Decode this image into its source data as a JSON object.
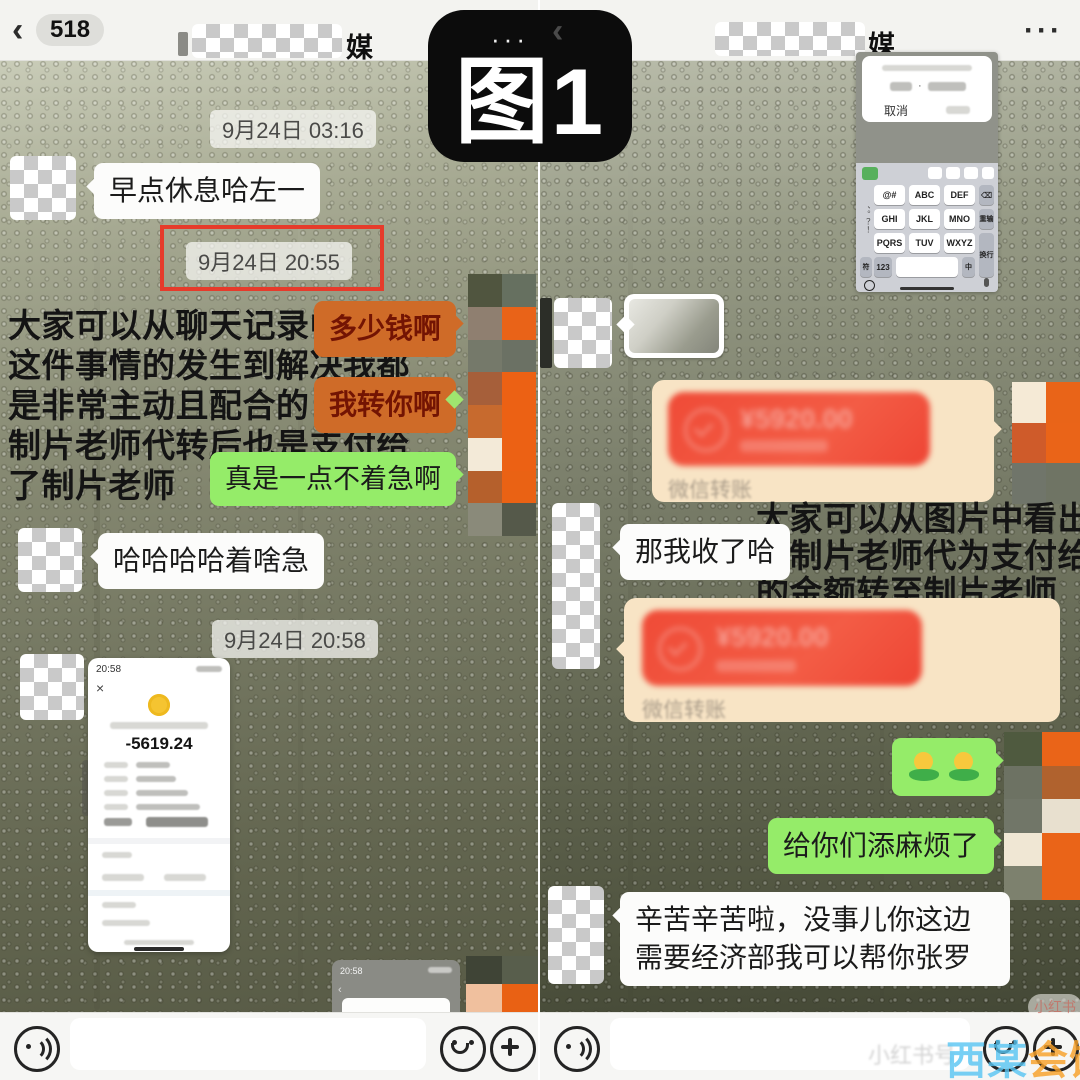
{
  "figure": {
    "label": "图1",
    "dots": "···"
  },
  "colors": {
    "wechat_green": "#95ec69",
    "highlight_orange": "#cf6b28",
    "transfer_cream": "#f8e4c5",
    "transfer_red": "#ef4b37",
    "annotation_red_box": "#e63b2b"
  },
  "left": {
    "header": {
      "back": "‹",
      "badge": "518",
      "title_suffix": "媒"
    },
    "dates": {
      "d1": "9月24日 03:16",
      "d2": "9月24日 20:55",
      "d3": "9月24日 20:58"
    },
    "messages": {
      "in1": "早点休息哈左一",
      "out_hl1": "多少钱啊",
      "out_hl2": "我转你啊",
      "out_green": "真是一点不着急啊",
      "in2": "哈哈哈哈着啥急"
    },
    "annotation": [
      "大家可以从聊天记录中看出",
      "这件事情的发生到解决我都",
      "是非常主动且配合的 工资由",
      "制片老师代转后也是支付给",
      "了制片老师"
    ],
    "payment": {
      "time": "20:58",
      "close": "×",
      "amount": "-5619.24"
    },
    "partial": {
      "time": "20:58"
    }
  },
  "right": {
    "header": {
      "back": "‹",
      "title_suffix": "媒",
      "menu": "···"
    },
    "dialog": {
      "cancel": "取消"
    },
    "keyboard": {
      "keys": [
        "@#",
        "ABC",
        "DEF",
        "GHI",
        "JKL",
        "MNO",
        "PQRS",
        "TUV",
        "WXYZ"
      ],
      "punct": "、。？！",
      "bottom": [
        "符",
        "123",
        "中"
      ],
      "right": [
        "⌫",
        "重输",
        "换行"
      ]
    },
    "messages": {
      "in1": "那我收了哈",
      "emoji": "🙇🙇",
      "out_green": "给你们添麻烦了",
      "in2": "辛苦辛苦啦，没事儿你这边需要经济部我可以帮你张罗"
    },
    "annotation": [
      "大家可以从图片中看出 我已",
      "将制片老师代为支付给小馒",
      "的金额转至制片老师"
    ],
    "transfer": {
      "amount": "¥5920.00",
      "label": "微信转账"
    }
  },
  "watermarks": {
    "pill": "小红书",
    "input_hint": "小红书号",
    "site_blue": "西某",
    "site_orange": "会馆"
  },
  "mosaics": {
    "left_strip": [
      "#50553f",
      "#667060",
      "#8f7f70",
      "#e96318",
      "#75796a",
      "#6b7164",
      "#a65f3a",
      "#ec6114",
      "#c76a2e",
      "#ec6114",
      "#f3ead8",
      "#ec6114",
      "#b5602c",
      "#ea6214",
      "#8a8a7a",
      "#55594a"
    ],
    "left_bottom": [
      "#3f4436",
      "#585e4c",
      "#f0c09e",
      "#e96114"
    ],
    "right_av1": [
      "#f5ead6",
      "#e96418",
      "#cf5b2a",
      "#ea6418",
      "#70756a",
      "#6f7464"
    ],
    "right_av2": [
      "#4f5a3f",
      "#ea6418",
      "#6d7263",
      "#b0622e",
      "#717668",
      "#e8e0cf",
      "#f0e7d4",
      "#ea6418",
      "#7d816e",
      "#ea6418"
    ]
  }
}
